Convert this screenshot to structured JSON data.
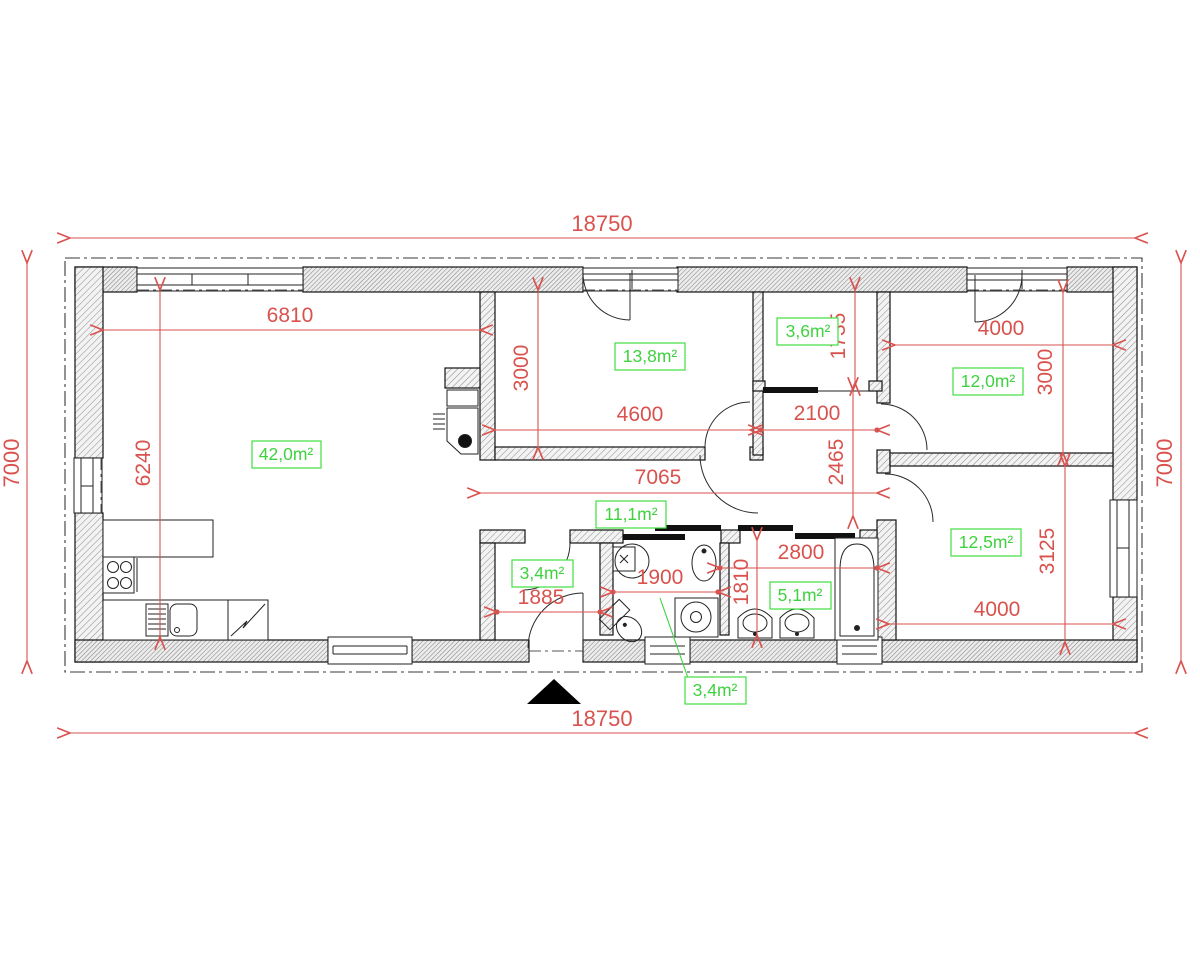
{
  "drawing": {
    "type": "architectural-floor-plan",
    "colors": {
      "dimension": "#d9524e",
      "area_label": "#3fd23f",
      "wall_outline": "#111111",
      "entrance_marker": "#000000"
    },
    "exterior_dims": {
      "top": "18750",
      "bottom": "18750",
      "left": "7000",
      "right": "7000"
    },
    "rooms": {
      "living": {
        "area": "42,0m²",
        "width": "6810",
        "height": "6240"
      },
      "bedroom_top": {
        "area": "13,8m²",
        "width": "4600",
        "height": "3000"
      },
      "closet": {
        "area": "3,6m²",
        "height": "1735",
        "corridor_width": "2100"
      },
      "bedroom_right_top": {
        "area": "12,0m²",
        "width": "4000",
        "height": "3000"
      },
      "hall": {
        "area": "11,1m²",
        "length": "7065",
        "depth": "2465"
      },
      "entry": {
        "area": "3,4m²",
        "width": "1885"
      },
      "wc": {
        "area": "3,4m²",
        "width": "1900"
      },
      "bathroom": {
        "area": "5,1m²",
        "width": "2800",
        "depth": "1810"
      },
      "bedroom_right_bottom": {
        "area": "12,5m²",
        "width": "4000",
        "height": "3125"
      }
    }
  }
}
